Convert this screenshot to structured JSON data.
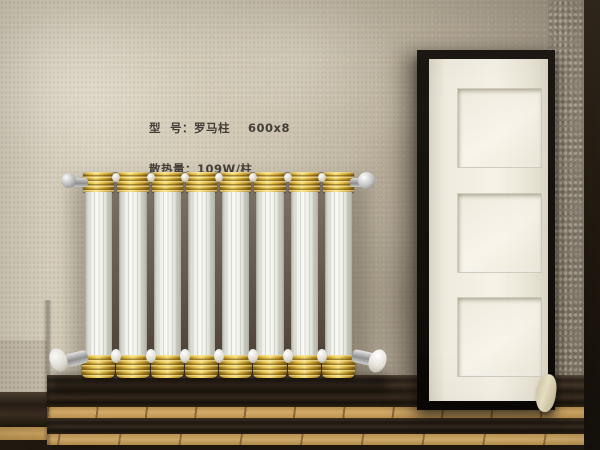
{
  "top_label": {
    "line1": "型  号：罗马柱    600x8",
    "line2": "散热量  109W/柱"
  },
  "specs": {
    "lines": [
      "型  号：罗马柱    600x8",
      "散热量：109W/柱",
      "材  质：冷轧低碳钢"
    ],
    "model_name": "罗马柱",
    "model_size": "600x8",
    "heat_output": "109W/柱",
    "material": "冷轧低碳钢"
  },
  "radiator": {
    "columns": 8,
    "style": "roman-column",
    "colors": {
      "gold": "#d9b236",
      "tube": "#f6f6f2",
      "gap_shadow": "#6b6255"
    }
  },
  "door": {
    "panels": 3,
    "colors": {
      "frame": "#14100b",
      "face": "#f3efe4"
    }
  },
  "scene_colors": {
    "wall_left": "#d6cfbc",
    "wall_right": "#93897a",
    "baseboard": "#2b221b",
    "wood_floor": "#d2a763",
    "right_band": "#1c150d",
    "text": "#34302b"
  }
}
